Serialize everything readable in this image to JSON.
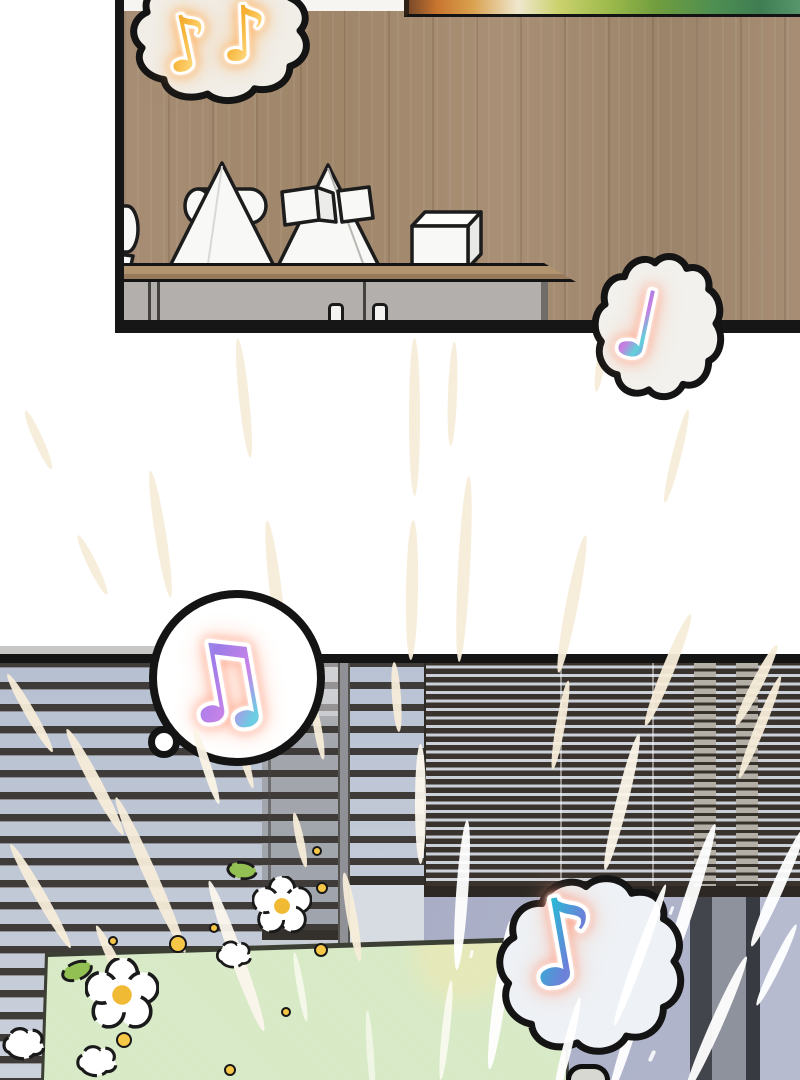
{
  "scene": {
    "type": "comic-page",
    "text": "none",
    "panels": [
      {
        "id": "living-room",
        "description": "wood-paneled wall, framed painting, sideboard with white geometric plaster sculptures (cone pierced by cylinder, pyramid with cubes, cube), grey cabinet with two handles"
      },
      {
        "id": "window",
        "description": "venetian blinds over windows, window frame posts, pale green mat with daisies, leaves, gold dots and white puffs, radiating speed lines"
      }
    ],
    "speech_bubbles": [
      {
        "id": "bubble-top-left",
        "shape": "cloud",
        "icon": "music-notes-gold-icon",
        "note_count": 2,
        "note_glyph": "♪",
        "note_style": "gold"
      },
      {
        "id": "bubble-top-right",
        "shape": "cloud",
        "icon": "music-note-holo-icon",
        "note_count": 1,
        "note_glyph": "♩",
        "note_style": "holographic-violet"
      },
      {
        "id": "bubble-bottom-left",
        "shape": "circle",
        "icon": "music-notes-beamed-icon",
        "note_count": 1,
        "note_glyph": "♫",
        "note_style": "holographic-pink"
      },
      {
        "id": "bubble-bottom-right",
        "shape": "cloud",
        "icon": "music-note-teal-icon",
        "note_count": 1,
        "note_glyph": "♪",
        "note_style": "holographic-teal"
      }
    ],
    "colors": {
      "outline": "#141414",
      "wood": "#a68d74",
      "shelf_wood": "#b2946f",
      "cabinet_grey": "#b2afac",
      "slat_dark": "#3e3b38",
      "sky_left": "#b6c0d1",
      "dense_gap": "#ccd1d9",
      "glass_right": "#aab0c8",
      "mat_green": "#d7e9c5",
      "mat_patch": "#f3e9a4",
      "streak_cream": "#f7ecd9",
      "gold_note": "#f6b133",
      "holo_note": "#8f7fe4",
      "teal_note": "#3fd4b5",
      "flower_center": "#f1ba35",
      "dot_gold": "#f6c646",
      "leaf_green": "#93c053"
    },
    "effects": {
      "speed_lines": [
        {
          "x": 38,
          "y": 408,
          "len": 64,
          "w": 9,
          "rot": -24
        },
        {
          "x": 92,
          "y": 532,
          "len": 66,
          "w": 9,
          "rot": -26
        },
        {
          "x": 160,
          "y": 470,
          "len": 128,
          "w": 11,
          "rot": -9
        },
        {
          "x": 244,
          "y": 338,
          "len": 120,
          "w": 10,
          "rot": -6
        },
        {
          "x": 276,
          "y": 520,
          "len": 146,
          "w": 12,
          "rot": -7
        },
        {
          "x": 414,
          "y": 338,
          "len": 158,
          "w": 11,
          "rot": 0
        },
        {
          "x": 452,
          "y": 342,
          "len": 104,
          "w": 9,
          "rot": 2
        },
        {
          "x": 412,
          "y": 520,
          "len": 140,
          "w": 12,
          "rot": 1
        },
        {
          "x": 464,
          "y": 476,
          "len": 186,
          "w": 12,
          "rot": 3
        },
        {
          "x": 600,
          "y": 340,
          "len": 52,
          "w": 8,
          "rot": 8
        },
        {
          "x": 676,
          "y": 408,
          "len": 96,
          "w": 9,
          "rot": 14
        },
        {
          "x": 572,
          "y": 534,
          "len": 140,
          "w": 12,
          "rot": 11
        },
        {
          "x": 668,
          "y": 610,
          "len": 120,
          "w": 12,
          "rot": 22
        },
        {
          "x": 756,
          "y": 640,
          "len": 90,
          "w": 11,
          "rot": 27
        },
        {
          "x": 30,
          "y": 668,
          "len": 90,
          "w": 10,
          "rot": -30
        },
        {
          "x": 95,
          "y": 722,
          "len": 120,
          "w": 12,
          "rot": -28
        },
        {
          "x": 40,
          "y": 836,
          "len": 120,
          "w": 11,
          "rot": -30
        },
        {
          "x": 150,
          "y": 790,
          "len": 170,
          "w": 13,
          "rot": -24
        },
        {
          "x": 236,
          "y": 876,
          "len": 160,
          "w": 13,
          "rot": -20,
          "c": "#fbf6ec"
        },
        {
          "x": 120,
          "y": 920,
          "len": 110,
          "w": 11,
          "rot": -26
        },
        {
          "x": 318,
          "y": 700,
          "len": 60,
          "w": 8,
          "rot": -10
        },
        {
          "x": 300,
          "y": 812,
          "len": 56,
          "w": 8,
          "rot": -12
        },
        {
          "x": 352,
          "y": 872,
          "len": 90,
          "w": 10,
          "rot": -10
        },
        {
          "x": 396,
          "y": 662,
          "len": 70,
          "w": 9,
          "rot": -4
        },
        {
          "x": 420,
          "y": 744,
          "len": 120,
          "w": 11,
          "rot": 0,
          "c": "#fbf6ec"
        },
        {
          "x": 462,
          "y": 820,
          "len": 150,
          "w": 12,
          "rot": 4,
          "c": "#ffffff"
        },
        {
          "x": 500,
          "y": 920,
          "len": 150,
          "w": 12,
          "rot": 8,
          "c": "#ffffff"
        },
        {
          "x": 560,
          "y": 680,
          "len": 90,
          "w": 9,
          "rot": 10
        },
        {
          "x": 622,
          "y": 732,
          "len": 140,
          "w": 12,
          "rot": 14,
          "c": "#fbf4e8"
        },
        {
          "x": 688,
          "y": 820,
          "len": 170,
          "w": 13,
          "rot": 18,
          "c": "#ffffff"
        },
        {
          "x": 760,
          "y": 672,
          "len": 110,
          "w": 10,
          "rot": 22
        },
        {
          "x": 778,
          "y": 822,
          "len": 130,
          "w": 12,
          "rot": 24,
          "c": "#ffffff"
        },
        {
          "x": 716,
          "y": 950,
          "len": 150,
          "w": 12,
          "rot": 24,
          "c": "#ffffff"
        },
        {
          "x": 628,
          "y": 980,
          "len": 120,
          "w": 10,
          "rot": 18,
          "c": "#ffffff"
        },
        {
          "x": 446,
          "y": 980,
          "len": 100,
          "w": 8,
          "rot": 6,
          "c": "#fffdf6",
          "o": 0.8
        },
        {
          "x": 300,
          "y": 952,
          "len": 70,
          "w": 7,
          "rot": -10,
          "c": "#fffdf6",
          "o": 0.7
        },
        {
          "x": 370,
          "y": 1010,
          "len": 90,
          "w": 7,
          "rot": -4,
          "c": "#fffdf6",
          "o": 0.6
        },
        {
          "x": 240,
          "y": 700,
          "len": 90,
          "w": 9,
          "rot": -16
        },
        {
          "x": 776,
          "y": 920,
          "len": 90,
          "w": 9,
          "rot": 26,
          "c": "#ffffff"
        },
        {
          "x": 640,
          "y": 880,
          "len": 150,
          "w": 10,
          "rot": 20,
          "c": "#ffffff",
          "front": true
        },
        {
          "x": 566,
          "y": 996,
          "len": 110,
          "w": 9,
          "rot": 14,
          "c": "#ffffff",
          "front": true
        },
        {
          "x": 206,
          "y": 726,
          "len": 80,
          "w": 9,
          "rot": -18,
          "c": "#fbf4e6",
          "front": true
        }
      ],
      "dots": [
        {
          "x": 113,
          "y": 941,
          "r": 5
        },
        {
          "x": 178,
          "y": 944,
          "r": 9
        },
        {
          "x": 214,
          "y": 928,
          "r": 5
        },
        {
          "x": 317,
          "y": 851,
          "r": 5
        },
        {
          "x": 322,
          "y": 888,
          "r": 6
        },
        {
          "x": 321,
          "y": 950,
          "r": 7
        },
        {
          "x": 124,
          "y": 1040,
          "r": 8
        },
        {
          "x": 230,
          "y": 1070,
          "r": 6
        },
        {
          "x": 286,
          "y": 1012,
          "r": 5
        }
      ],
      "sparkles": [
        {
          "x": 604,
          "y": 930,
          "w": 4,
          "h": 12,
          "rot": 25
        },
        {
          "x": 585,
          "y": 1002,
          "w": 4,
          "h": 10,
          "rot": 20
        },
        {
          "x": 650,
          "y": 1050,
          "w": 4,
          "h": 12,
          "rot": 25
        },
        {
          "x": 670,
          "y": 906,
          "w": 3,
          "h": 9,
          "rot": 20
        },
        {
          "x": 470,
          "y": 950,
          "w": 3,
          "h": 8,
          "rot": 15
        },
        {
          "x": 618,
          "y": 966,
          "w": 5,
          "h": 5,
          "rot": 0
        }
      ]
    }
  }
}
